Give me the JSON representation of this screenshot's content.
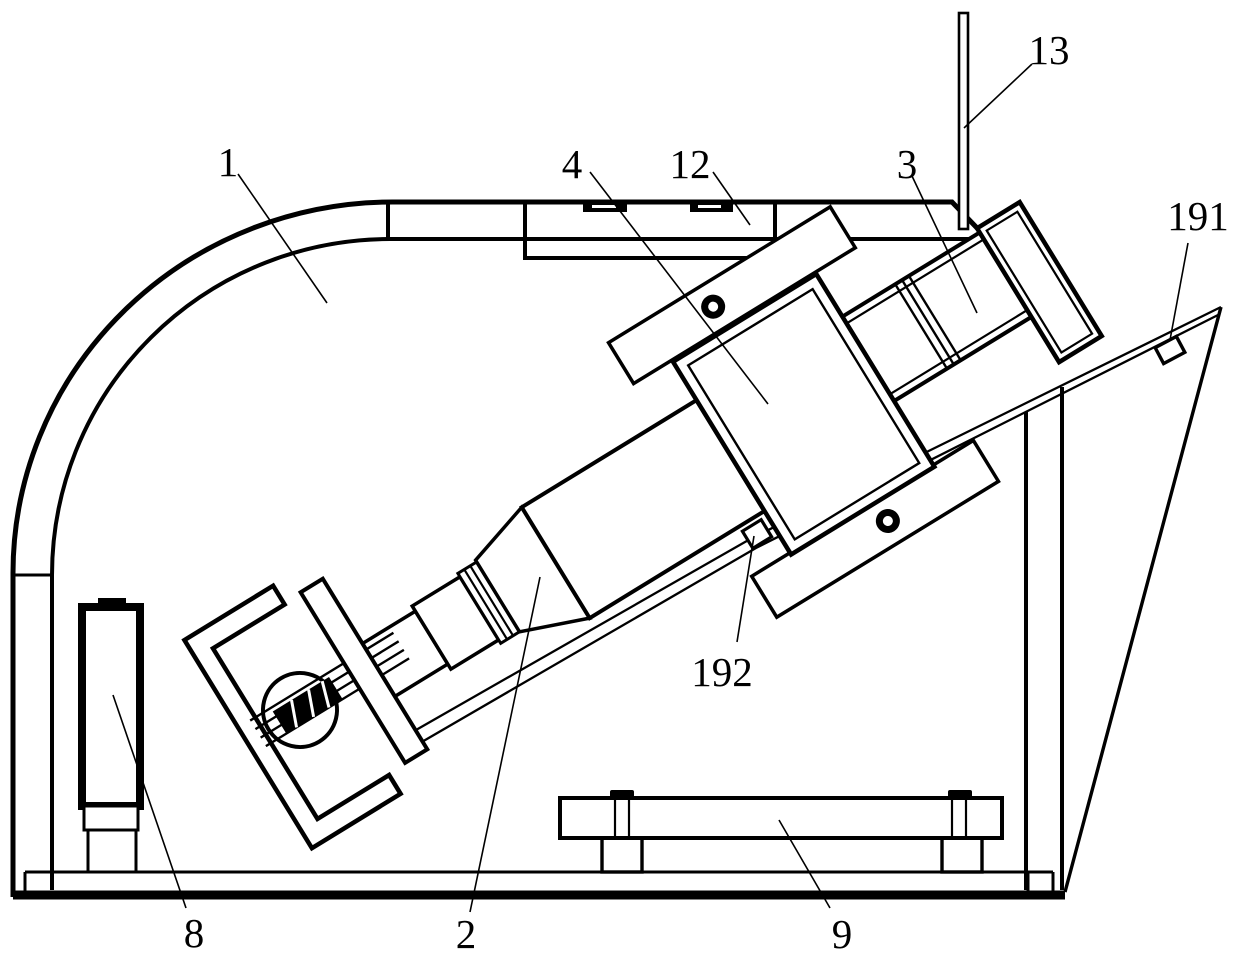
{
  "figure": {
    "type": "patent-technical-line-drawing",
    "background_color": "#ffffff",
    "line_color": "#000000",
    "labels": [
      {
        "text": "1",
        "x": 228,
        "y": 176,
        "leader": [
          238,
          174,
          327,
          303
        ]
      },
      {
        "text": "2",
        "x": 466,
        "y": 948,
        "leader": [
          470,
          912,
          540,
          577
        ]
      },
      {
        "text": "3",
        "x": 907,
        "y": 178,
        "leader": [
          912,
          176,
          977,
          313
        ]
      },
      {
        "text": "4",
        "x": 572,
        "y": 178,
        "leader": [
          590,
          172,
          768,
          404
        ]
      },
      {
        "text": "8",
        "x": 194,
        "y": 947,
        "leader": [
          186,
          908,
          113,
          695
        ]
      },
      {
        "text": "9",
        "x": 842,
        "y": 948,
        "leader": [
          830,
          908,
          779,
          820
        ]
      },
      {
        "text": "12",
        "x": 690,
        "y": 178,
        "leader": [
          713,
          172,
          750,
          225
        ]
      },
      {
        "text": "13",
        "x": 1049,
        "y": 64,
        "leader": [
          1032,
          64,
          964,
          128
        ]
      },
      {
        "text": "191",
        "x": 1198,
        "y": 230,
        "leader": [
          1188,
          243,
          1170,
          340
        ]
      },
      {
        "text": "192",
        "x": 722,
        "y": 686,
        "leader": [
          737,
          642,
          754,
          536
        ]
      }
    ]
  }
}
